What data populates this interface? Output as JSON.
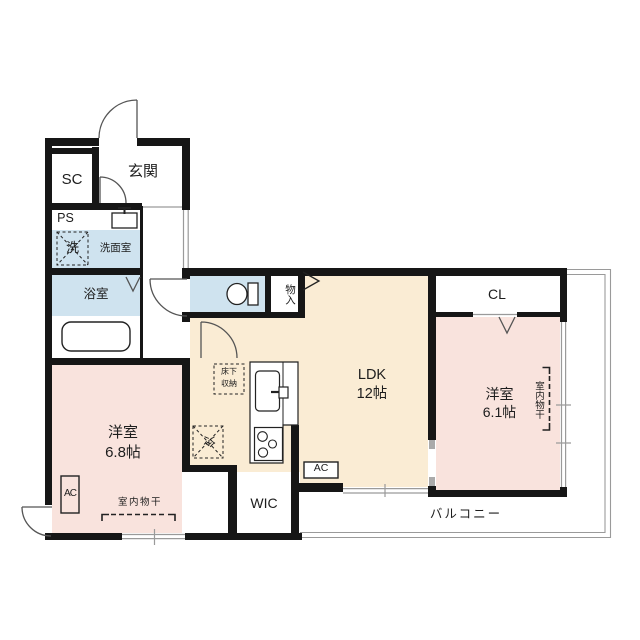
{
  "rooms": {
    "genkan": {
      "label": "玄関"
    },
    "shoe_closet": {
      "label": "SC"
    },
    "pipe_space": {
      "label": "PS"
    },
    "washroom": {
      "label": "洗面室"
    },
    "bathroom": {
      "label": "浴室"
    },
    "storage": {
      "label": "物入"
    },
    "ldk": {
      "label": "LDK",
      "size": "12帖"
    },
    "closet": {
      "label": "CL"
    },
    "bedroom_east": {
      "label": "洋室",
      "size": "6.1帖"
    },
    "bedroom_west": {
      "label": "洋室",
      "size": "6.8帖"
    },
    "walk_in_closet": {
      "label": "WIC"
    },
    "balcony": {
      "label": "バルコニー"
    }
  },
  "fixtures": {
    "washing_machine": {
      "label": "洗"
    },
    "refrigerator": {
      "label": "冷"
    },
    "underfloor_storage": {
      "line1": "床下",
      "line2": "収納"
    },
    "ac_ldk": {
      "label": "AC"
    },
    "ac_bedroom_west": {
      "label": "AC"
    },
    "indoor_drying_west": {
      "label": "室内物干"
    },
    "indoor_drying_east": {
      "label": "室内物干"
    }
  },
  "colors": {
    "wall": "#161616",
    "ldk_floor": "#faecd4",
    "bedroom_floor": "#f9e3dd",
    "wet_floor": "#cfe3ef",
    "outline": "#9a9a9a"
  }
}
